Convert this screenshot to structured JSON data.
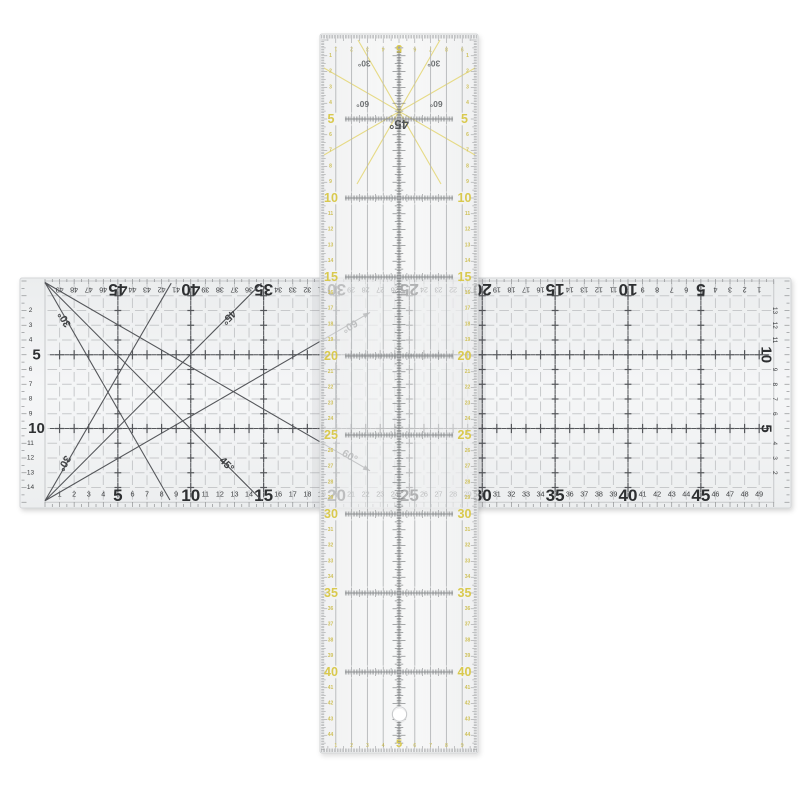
{
  "scene": {
    "background": "#ffffff",
    "description": "Two transparent acrylic patchwork quilting rulers laid across each other in a cross arrangement on a white background: a 50 cm x 15 cm grid ruler (horizontal) and a 45 cm x 10 cm yellow-accent ruler (vertical)"
  },
  "horizontal_ruler": {
    "unit": "cm",
    "length_cm": 50,
    "width_cm": 15,
    "bottom_scale": {
      "min": 1,
      "max": 49,
      "bold_values": [
        5,
        10,
        15,
        20,
        25,
        30,
        35,
        40,
        45
      ]
    },
    "top_scale": {
      "min": 1,
      "max": 49,
      "bold_values": [
        5,
        10,
        15,
        20,
        25,
        30,
        35,
        40,
        45
      ],
      "orientation": "rotated-180"
    },
    "left_scale": {
      "min": 2,
      "max": 14,
      "bold_values": [
        5,
        10
      ]
    },
    "right_scale": {
      "min": 2,
      "max": 13,
      "bold_values": [
        5,
        10
      ]
    },
    "angle_lines_deg": [
      30,
      45,
      60
    ],
    "angle_labels": [
      {
        "text": "30°",
        "x_cm": 1.35,
        "y_cm": 2.6,
        "rot": 240
      },
      {
        "text": "45°",
        "x_cm": 12.6,
        "y_cm": 2.45,
        "rot": 135
      },
      {
        "text": "60°",
        "x_cm": 20.9,
        "y_cm": 3.05,
        "rot": 150
      },
      {
        "text": "30°",
        "x_cm": 1.3,
        "y_cm": 12.35,
        "rot": 120
      },
      {
        "text": "45°",
        "x_cm": 12.45,
        "y_cm": 12.45,
        "rot": 45
      },
      {
        "text": "60°",
        "x_cm": 20.9,
        "y_cm": 11.9,
        "rot": 30
      }
    ],
    "colors": {
      "ink": "#2e3032",
      "small_ink": "#3c3e40",
      "grid": "#c7c9cb",
      "body": "#f0f1f2",
      "mark": "#54565a",
      "edge_tick": "#8f9193"
    }
  },
  "vertical_ruler": {
    "unit": "cm",
    "length_cm": 45,
    "width_cm": 10,
    "side_scale_values": [
      5,
      10,
      15,
      20,
      25,
      30,
      35,
      40
    ],
    "edge_scale": {
      "min": 1,
      "max": 44
    },
    "top_width_scale": {
      "min": 1,
      "max": 9,
      "center_label": "5"
    },
    "bottom_width_scale": {
      "min": 1,
      "max": 9,
      "center_label": "5"
    },
    "angle_labels": [
      {
        "text": "30°",
        "x_cm": 2.8,
        "y_cm": 1.5
      },
      {
        "text": "30°",
        "x_cm": 7.2,
        "y_cm": 1.5
      },
      {
        "text": "60°",
        "x_cm": 2.7,
        "y_cm": 4.05
      },
      {
        "text": "60°",
        "x_cm": 7.35,
        "y_cm": 4.05
      },
      {
        "text": "45°",
        "x_cm": 5.0,
        "y_cm": 5.35
      }
    ],
    "has_hang_hole": true,
    "colors": {
      "accent": "#d9c94e",
      "accent_line": "#e6da85",
      "tiny_accent": "#cfc15a",
      "line": "#8a8d8f",
      "faint_line": "#b4b7b9",
      "label": "#6f7274",
      "tick": "#97999b",
      "center": "#6e7173"
    }
  }
}
